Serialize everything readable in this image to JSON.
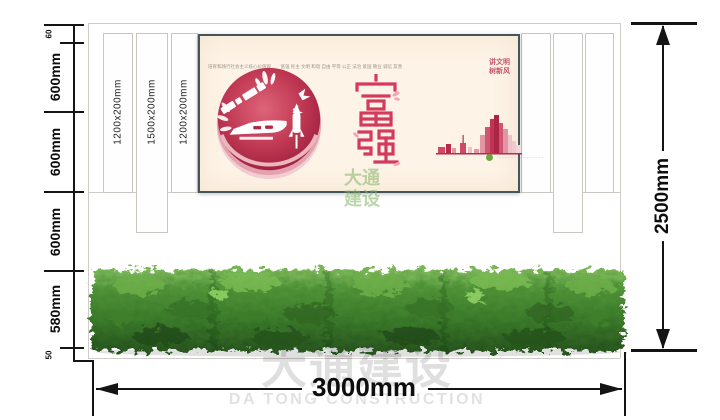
{
  "dims": {
    "left": [
      "60",
      "600mm",
      "600mm",
      "600mm",
      "580mm",
      "50"
    ],
    "right": "2500mm",
    "bottom": "3000mm"
  },
  "slats": {
    "labels": [
      "1200x200mm",
      "1500x200mm",
      "1200x200mm"
    ]
  },
  "poster": {
    "tagline": "培育和践行社会主义核心价值观",
    "values": "富强 民主 文明 和谐 自由 平等 公正 法治 爱国 敬业 诚信 友善",
    "slogan": {
      "line1": "讲文明",
      "line2": "树新风"
    },
    "theme_chars": "富强",
    "credit": "·······························"
  },
  "watermark": {
    "cn": "大通建设",
    "en": "DA TONG CONSTRUCTION",
    "tile_line1": "大通",
    "tile_line2": "建设"
  },
  "colors": {
    "accent_red": "#d43a5e",
    "crimson": "#b02a46",
    "poster_cream": "#fdf3e6",
    "hedge_green": "#3a7a2a",
    "frame_dark": "#465559",
    "dimension_black": "#141414"
  }
}
